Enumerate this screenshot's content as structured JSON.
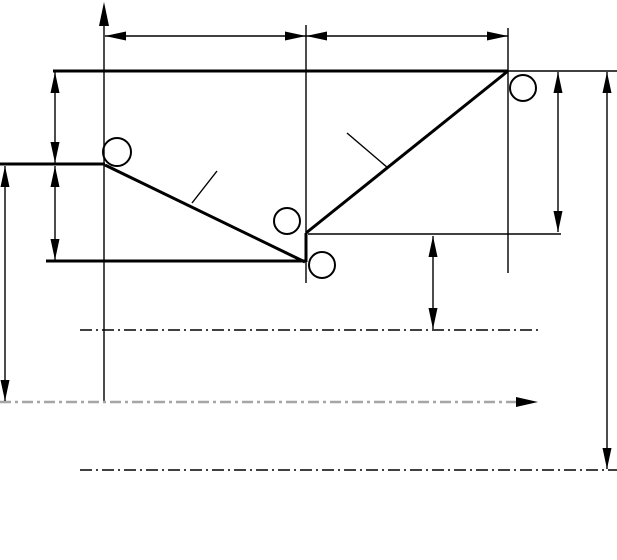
{
  "canvas": {
    "width": 617,
    "height": 560,
    "background": "#ffffff"
  },
  "style": {
    "ink": "#000000",
    "centerline_gray": "#a6a6a6",
    "thick_width": 3,
    "thin_width": 1.4,
    "circle_stroke_width": 2,
    "dim_arrow_length": 21,
    "dim_arrow_half_width": 4.5,
    "dashdot_black_pattern": "12 4 2 4",
    "dashdot_gray_pattern": "11 4 3 4"
  },
  "outline_lines": [
    {
      "name": "top-edge-line",
      "x1": 53,
      "y1": 71,
      "x2": 508,
      "y2": 71
    },
    {
      "name": "left-step-line",
      "x1": 0,
      "y1": 164,
      "x2": 105,
      "y2": 164
    },
    {
      "name": "bottom-edge-line",
      "x1": 46,
      "y1": 261,
      "x2": 306,
      "y2": 261
    },
    {
      "name": "left-slope-line",
      "x1": 105,
      "y1": 165,
      "x2": 305,
      "y2": 262
    },
    {
      "name": "center-step-line",
      "x1": 306,
      "y1": 262,
      "x2": 306,
      "y2": 233
    },
    {
      "name": "right-slope-line",
      "x1": 306,
      "y1": 233,
      "x2": 508,
      "y2": 71
    }
  ],
  "thin_lines": [
    {
      "name": "vertical-axis-line",
      "x1": 104,
      "y1": 8,
      "x2": 104,
      "y2": 402
    },
    {
      "name": "center-extension-line",
      "x1": 306,
      "y1": 25,
      "x2": 306,
      "y2": 283
    },
    {
      "name": "right-extension-line",
      "x1": 508,
      "y1": 28,
      "x2": 508,
      "y2": 273
    },
    {
      "name": "top-right-extension-line",
      "x1": 508,
      "y1": 71,
      "x2": 617,
      "y2": 71
    },
    {
      "name": "mid-horizontal-line",
      "x1": 308,
      "y1": 234,
      "x2": 561,
      "y2": 234
    },
    {
      "name": "left-slope-leader-line",
      "x1": 192,
      "y1": 203,
      "x2": 217,
      "y2": 171
    },
    {
      "name": "right-slope-leader-line",
      "x1": 388,
      "y1": 168,
      "x2": 347,
      "y2": 133
    }
  ],
  "dimension_lines": [
    {
      "name": "dim-top-left-width",
      "x1": 105,
      "y1": 36,
      "x2": 306,
      "y2": 36
    },
    {
      "name": "dim-top-right-width",
      "x1": 306,
      "y1": 36,
      "x2": 508,
      "y2": 36
    },
    {
      "name": "dim-left-upper-height",
      "x1": 55,
      "y1": 72,
      "x2": 55,
      "y2": 163
    },
    {
      "name": "dim-left-lower-height",
      "x1": 55,
      "y1": 166,
      "x2": 55,
      "y2": 260
    },
    {
      "name": "dim-far-left-height",
      "x1": 5,
      "y1": 166,
      "x2": 5,
      "y2": 401
    },
    {
      "name": "dim-center-drop",
      "x1": 433,
      "y1": 236,
      "x2": 433,
      "y2": 329
    },
    {
      "name": "dim-right-inner-height",
      "x1": 558,
      "y1": 72,
      "x2": 558,
      "y2": 232
    },
    {
      "name": "dim-far-right-height",
      "x1": 607,
      "y1": 72,
      "x2": 607,
      "y2": 469
    }
  ],
  "single_arrowheads": [
    {
      "name": "axis-arrowhead",
      "tip_x": 104,
      "tip_y": 2,
      "direction": "up",
      "length": 24,
      "half_width": 5
    },
    {
      "name": "centerline-arrowhead",
      "tip_x": 538,
      "tip_y": 402,
      "direction": "right",
      "length": 22,
      "half_width": 5
    }
  ],
  "centerlines": [
    {
      "name": "upper-centerline",
      "x1": 80,
      "y1": 330,
      "x2": 542,
      "y2": 330,
      "color": "black",
      "width": 1.6
    },
    {
      "name": "main-centerline",
      "x1": 0,
      "y1": 402,
      "x2": 519,
      "y2": 402,
      "color": "gray",
      "width": 2.4
    },
    {
      "name": "lower-centerline",
      "x1": 80,
      "y1": 470,
      "x2": 617,
      "y2": 470,
      "color": "black",
      "width": 1.6
    }
  ],
  "circles": [
    {
      "name": "marker-circle-left",
      "cx": 117,
      "cy": 152,
      "r": 14
    },
    {
      "name": "marker-circle-center-upper",
      "cx": 287,
      "cy": 221,
      "r": 13
    },
    {
      "name": "marker-circle-center-lower",
      "cx": 322,
      "cy": 265,
      "r": 13
    },
    {
      "name": "marker-circle-right",
      "cx": 523,
      "cy": 88,
      "r": 13
    }
  ]
}
